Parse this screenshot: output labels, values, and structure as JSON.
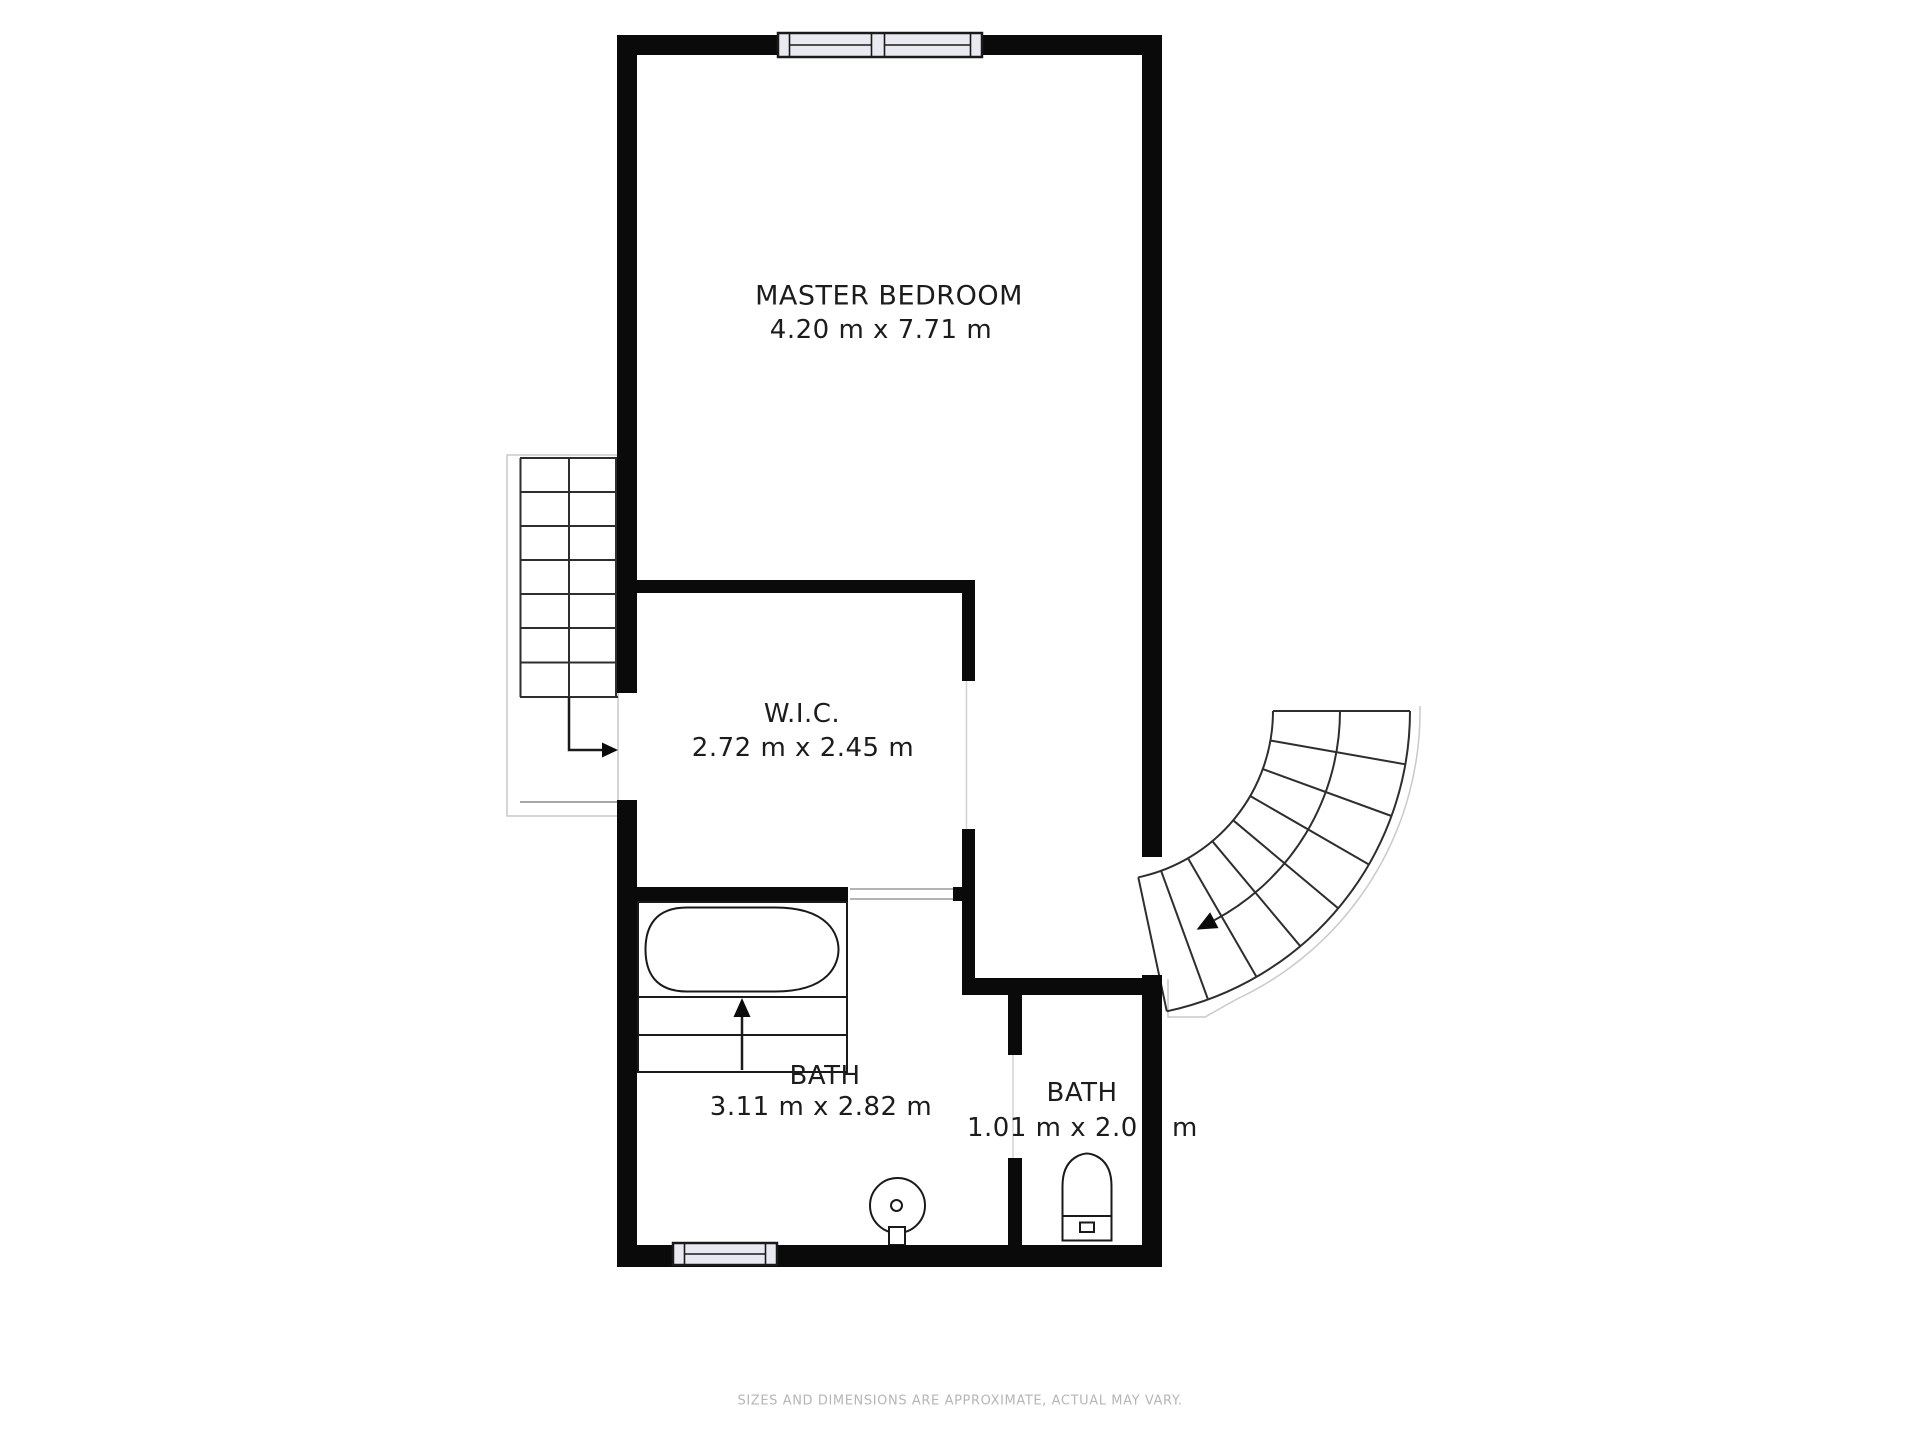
{
  "rooms": [
    {
      "id": "master-bedroom",
      "name": "MASTER BEDROOM",
      "dims": "4.20 m x 7.71 m"
    },
    {
      "id": "wic",
      "name": "W.I.C.",
      "dims": "2.72 m x 2.45 m"
    },
    {
      "id": "bath-large",
      "name": "BATH",
      "dims": "3.11 m x 2.82 m"
    },
    {
      "id": "bath-small",
      "name": "BATH",
      "dims": "1.01 m x 2.0",
      "dims_tail": "m"
    }
  ],
  "footer": {
    "disclaimer": "SIZES AND DIMENSIONS ARE APPROXIMATE, ACTUAL MAY VARY."
  },
  "fixtures": [
    "bathtub",
    "tub-steps",
    "sink",
    "toilet",
    "straight-staircase",
    "curved-staircase",
    "window",
    "window"
  ],
  "colors": {
    "wall": "#0a0a0a",
    "ink": "#1a1a1a",
    "window_fill": "#e9eaf1",
    "outline": "#c9c9c9",
    "text": "#1c1c1c",
    "muted_text": "#b6b6b6",
    "background": "#ffffff"
  }
}
